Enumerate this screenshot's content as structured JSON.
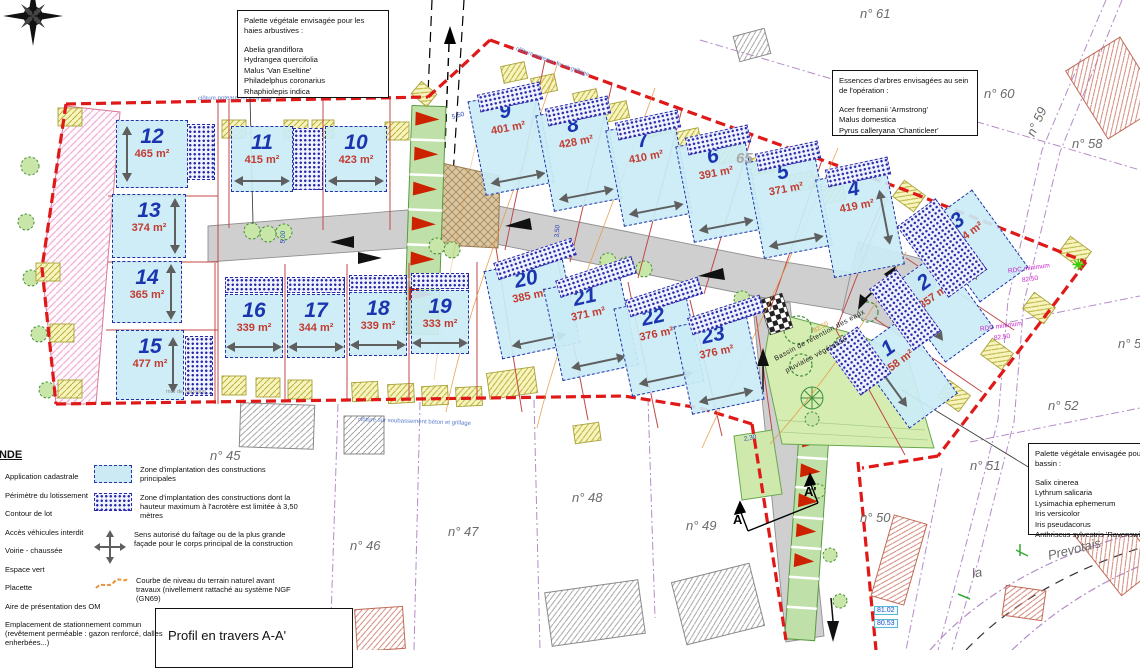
{
  "boxes": {
    "hedge_palette": {
      "title": "Palette végétale envisagée pour les haies arbustives :",
      "species": [
        "Abelia grandiflora",
        "Hydrangea quercifolia",
        "Malus 'Van Eseltine'",
        "Philadelphus coronarius",
        "Rhaphiolepis indica"
      ]
    },
    "tree_species": {
      "title": "Essences d'arbres envisagées au sein de l'opération :",
      "species": [
        "Acer freemanii 'Armstrong'",
        "Malus domestica",
        "Pyrus calleryana 'Chanticleer'"
      ]
    },
    "basin_palette": {
      "title": "Palette végétale envisagée pour le bassin :",
      "species": [
        "Salix cinerea",
        "Lythrum salicaria",
        "Lysimachia ephemerum",
        "Iris versicolor",
        "Iris pseudacorus",
        "Anthriscus sylvestris 'Ravenswing'"
      ]
    },
    "profile": {
      "label": "Profil en travers A-A'"
    }
  },
  "legend": {
    "title": "LEGENDE",
    "left_items": [
      "Application cadastrale",
      "Périmètre du lotissement",
      "Contour de lot",
      "Accès véhicules interdit",
      "Voirie - chaussée",
      "Espace vert",
      "Placette",
      "Aire de présentation des OM",
      "Emplacement de stationnement commun (revêtement perméable : gazon renforcé, dalles enherbées...)"
    ],
    "right_items": [
      {
        "icon": "zone-implantation-principale",
        "text": "Zone d'implantation des constructions principales"
      },
      {
        "icon": "zone-implantation-acrotere",
        "text": "Zone d'implantation des constructions dont la hauteur maximum à l'acrotère est limitée à 3,50 mètres"
      },
      {
        "icon": "sens-faitage",
        "text": "Sens autorisé du faîtage ou de la plus grande façade pour le corps principal de la construction"
      },
      {
        "icon": "courbe-niveau",
        "text": "Courbe de niveau du terrain naturel avant travaux (nivellement rattaché au système NGF (GN69)"
      }
    ]
  },
  "lots": [
    {
      "n": "12",
      "a": "465 m²",
      "x": 116,
      "y": 120,
      "w": 72,
      "h": 68,
      "r": 0,
      "ar": "v",
      "as": "left"
    },
    {
      "n": "11",
      "a": "415 m²",
      "x": 231,
      "y": 126,
      "w": 62,
      "h": 66,
      "r": 0,
      "ar": "h"
    },
    {
      "n": "10",
      "a": "423 m²",
      "x": 325,
      "y": 126,
      "w": 62,
      "h": 66,
      "r": 0,
      "ar": "h"
    },
    {
      "n": "13",
      "a": "374 m²",
      "x": 112,
      "y": 194,
      "w": 74,
      "h": 64,
      "r": 0,
      "ar": "v",
      "as": "right"
    },
    {
      "n": "14",
      "a": "365 m²",
      "x": 112,
      "y": 261,
      "w": 70,
      "h": 62,
      "r": 0,
      "ar": "v",
      "as": "right"
    },
    {
      "n": "15",
      "a": "477 m²",
      "x": 116,
      "y": 330,
      "w": 68,
      "h": 70,
      "r": 0,
      "ar": "v",
      "as": "right"
    },
    {
      "n": "16",
      "a": "339 m²",
      "x": 225,
      "y": 294,
      "w": 58,
      "h": 64,
      "r": 0,
      "ar": "h"
    },
    {
      "n": "17",
      "a": "344 m²",
      "x": 287,
      "y": 294,
      "w": 58,
      "h": 64,
      "r": 0,
      "ar": "h"
    },
    {
      "n": "18",
      "a": "339 m²",
      "x": 349,
      "y": 292,
      "w": 58,
      "h": 64,
      "r": 0,
      "ar": "h"
    },
    {
      "n": "19",
      "a": "333 m²",
      "x": 411,
      "y": 290,
      "w": 58,
      "h": 64,
      "r": 0,
      "ar": "h"
    },
    {
      "n": "9",
      "a": "401 m²",
      "x": 476,
      "y": 94,
      "w": 70,
      "h": 96,
      "r": -11,
      "ar": "h"
    },
    {
      "n": "8",
      "a": "428 m²",
      "x": 544,
      "y": 108,
      "w": 70,
      "h": 98,
      "r": -11,
      "ar": "h"
    },
    {
      "n": "7",
      "a": "410 m²",
      "x": 614,
      "y": 123,
      "w": 70,
      "h": 98,
      "r": -11,
      "ar": "h"
    },
    {
      "n": "6",
      "a": "391 m²",
      "x": 684,
      "y": 139,
      "w": 70,
      "h": 98,
      "r": -11,
      "ar": "h"
    },
    {
      "n": "5",
      "a": "371 m²",
      "x": 754,
      "y": 155,
      "w": 70,
      "h": 98,
      "r": -11,
      "ar": "h"
    },
    {
      "n": "4",
      "a": "419 m²",
      "x": 824,
      "y": 172,
      "w": 72,
      "h": 100,
      "r": -11,
      "ar": "v",
      "as": "right"
    },
    {
      "n": "20",
      "a": "385 m²",
      "x": 492,
      "y": 262,
      "w": 80,
      "h": 90,
      "r": -12,
      "ar": "h"
    },
    {
      "n": "21",
      "a": "371 m²",
      "x": 552,
      "y": 280,
      "w": 78,
      "h": 94,
      "r": -12,
      "ar": "h"
    },
    {
      "n": "22",
      "a": "376 m²",
      "x": 622,
      "y": 300,
      "w": 74,
      "h": 90,
      "r": -12,
      "ar": "h"
    },
    {
      "n": "23",
      "a": "376 m²",
      "x": 682,
      "y": 318,
      "w": 74,
      "h": 90,
      "r": -12,
      "ar": "h"
    },
    {
      "n": "3",
      "a": "504 m²",
      "x": 946,
      "y": 198,
      "w": 60,
      "h": 96,
      "r": -36,
      "ar": "v",
      "as": "left"
    },
    {
      "n": "2",
      "a": "357 m²",
      "x": 912,
      "y": 260,
      "w": 60,
      "h": 94,
      "r": -36,
      "ar": "v",
      "as": "left"
    },
    {
      "n": "1",
      "a": "358 m²",
      "x": 876,
      "y": 326,
      "w": 60,
      "h": 94,
      "r": -36,
      "ar": "v",
      "as": "left"
    }
  ],
  "hatch_strips": [
    [
      187,
      124,
      28,
      56,
      0
    ],
    [
      293,
      128,
      30,
      62,
      0
    ],
    [
      185,
      336,
      28,
      60,
      0
    ],
    [
      225,
      277,
      58,
      16,
      0
    ],
    [
      287,
      277,
      58,
      16,
      0
    ],
    [
      349,
      275,
      58,
      16,
      0
    ],
    [
      411,
      273,
      58,
      16,
      0
    ],
    [
      478,
      88,
      64,
      18,
      -12
    ],
    [
      546,
      102,
      64,
      18,
      -12
    ],
    [
      616,
      116,
      64,
      18,
      -12
    ],
    [
      686,
      131,
      64,
      18,
      -12
    ],
    [
      756,
      147,
      64,
      18,
      -12
    ],
    [
      826,
      163,
      64,
      18,
      -12
    ],
    [
      494,
      250,
      82,
      18,
      -18
    ],
    [
      556,
      268,
      80,
      18,
      -18
    ],
    [
      626,
      288,
      76,
      18,
      -18
    ],
    [
      688,
      306,
      76,
      18,
      -18
    ],
    [
      918,
      204,
      48,
      88,
      -36
    ],
    [
      888,
      272,
      34,
      76,
      -36
    ],
    [
      840,
      332,
      38,
      58,
      -36
    ]
  ],
  "parcel_labels": [
    {
      "t": "n° 61",
      "x": 860,
      "y": 6,
      "r": 0
    },
    {
      "t": "n° 60",
      "x": 984,
      "y": 86,
      "r": 0
    },
    {
      "t": "n° 59",
      "x": 1030,
      "y": 128,
      "r": -65
    },
    {
      "t": "n° 58",
      "x": 1072,
      "y": 136,
      "r": 0
    },
    {
      "t": "n° 5",
      "x": 1118,
      "y": 336,
      "r": 0
    },
    {
      "t": "n° 52",
      "x": 1048,
      "y": 398,
      "r": 0
    },
    {
      "t": "n° 51",
      "x": 970,
      "y": 458,
      "r": 0
    },
    {
      "t": "n° 50",
      "x": 860,
      "y": 510,
      "r": 0
    },
    {
      "t": "n° 49",
      "x": 686,
      "y": 518,
      "r": 0
    },
    {
      "t": "n° 48",
      "x": 572,
      "y": 490,
      "r": 0
    },
    {
      "t": "n° 47",
      "x": 448,
      "y": 524,
      "r": 0
    },
    {
      "t": "n° 46",
      "x": 350,
      "y": 538,
      "r": 0
    },
    {
      "t": "n° 45",
      "x": 210,
      "y": 448,
      "r": 0
    },
    {
      "t": "la",
      "x": 972,
      "y": 566,
      "r": -10
    },
    {
      "t": "Prevotais",
      "x": 1048,
      "y": 548,
      "r": -14
    }
  ],
  "annotations": [
    {
      "t": "65",
      "x": 736,
      "y": 150,
      "r": 0,
      "c": "faint"
    },
    {
      "t": "RDC minimum",
      "x": 1008,
      "y": 268,
      "r": -8,
      "c": "rdc"
    },
    {
      "t": "82.50",
      "x": 1022,
      "y": 277,
      "r": -8,
      "c": "rdc"
    },
    {
      "t": "RDC minimum",
      "x": 980,
      "y": 326,
      "r": -8,
      "c": "rdc"
    },
    {
      "t": "82.50",
      "x": 994,
      "y": 335,
      "r": -8,
      "c": "rdc"
    },
    {
      "t": "81.02",
      "x": 874,
      "y": 606,
      "r": 0,
      "c": "elev"
    },
    {
      "t": "80.53",
      "x": 874,
      "y": 619,
      "r": 0,
      "c": "elev"
    },
    {
      "t": "5,50",
      "x": 452,
      "y": 114,
      "r": -15,
      "c": "dim"
    },
    {
      "t": "3,50",
      "x": 557,
      "y": 234,
      "r": -85,
      "c": "dim"
    },
    {
      "t": "5,00",
      "x": 283,
      "y": 240,
      "r": -88,
      "c": "dim"
    },
    {
      "t": "2,30",
      "x": 744,
      "y": 436,
      "r": -12,
      "c": "dim"
    },
    {
      "t": "clôture poteaux fer et grillage",
      "x": 198,
      "y": 96,
      "r": -1,
      "c": "fence"
    },
    {
      "t": "clôture poteaux fer et grillage",
      "x": 516,
      "y": 46,
      "r": 20,
      "c": "fence"
    },
    {
      "t": "clôture sur soubassement béton et grillage",
      "x": 358,
      "y": 417,
      "r": 2,
      "c": "fence"
    },
    {
      "t": "mur de parpaing",
      "x": 166,
      "y": 389,
      "r": 0,
      "c": "mur"
    },
    {
      "t": "Bassin de rétention des eaux",
      "x": 775,
      "y": 356,
      "r": -28,
      "c": "bassinlbl"
    },
    {
      "t": "pluviales végétalisé",
      "x": 786,
      "y": 368,
      "r": -28,
      "c": "bassinlbl"
    },
    {
      "t": "82.50",
      "x": 814,
      "y": 328,
      "r": -30,
      "c": "contour"
    },
    {
      "t": "A",
      "x": 733,
      "y": 512,
      "r": 0,
      "c": "section"
    },
    {
      "t": "A'",
      "x": 804,
      "y": 484,
      "r": 0,
      "c": "section"
    },
    {
      "t": "✳",
      "x": 1072,
      "y": 256,
      "r": 0,
      "c": "star"
    }
  ],
  "colors": {
    "perimeter": "#e01818",
    "lot_fill": "#cdeef6",
    "lot_border": "#2433a8",
    "lot_number": "#1b35b0",
    "lot_area": "#c23b30",
    "road": "#cfcfcf",
    "green_space": "#bfe0a8",
    "height_zone_hatch": "#2a2aa8",
    "cadastral": "#b48cc8",
    "contour": "#e8923a"
  }
}
